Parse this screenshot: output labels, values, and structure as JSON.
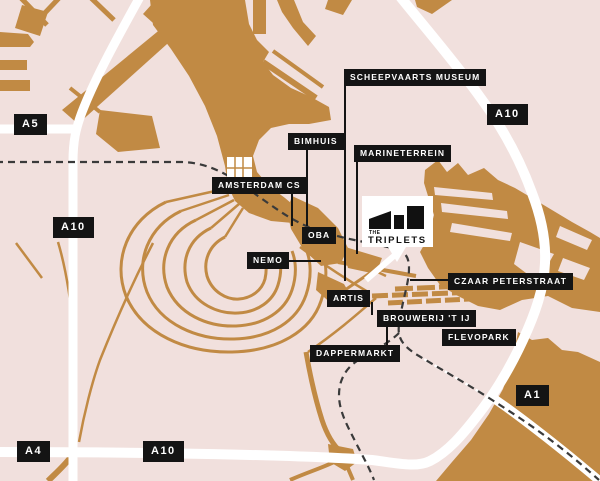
{
  "palette": {
    "background_pink": "#f1e0dd",
    "water_gold": "#c18a44",
    "road_white": "#ffffff",
    "label_background": "#141414",
    "label_text": "#ffffff",
    "railway_dash": "#3a3a3a",
    "logo_black": "#111111"
  },
  "labels": [
    {
      "id": "scheepvaarts-museum",
      "text": "SCHEEPVAARTS MUSEUM"
    },
    {
      "id": "a10-northeast",
      "text": "A10"
    },
    {
      "id": "a5",
      "text": "A5"
    },
    {
      "id": "bimhuis",
      "text": "BIMHUIS"
    },
    {
      "id": "marineterrein",
      "text": "MARINETERREIN"
    },
    {
      "id": "amsterdam-cs",
      "text": "AMSTERDAM CS"
    },
    {
      "id": "a10-west",
      "text": "A10"
    },
    {
      "id": "oba",
      "text": "OBA"
    },
    {
      "id": "nemo",
      "text": "NEMO"
    },
    {
      "id": "czaar-peterstraat",
      "text": "CZAAR PETERSTRAAT"
    },
    {
      "id": "artis",
      "text": "ARTIS"
    },
    {
      "id": "brouwerij-t-ij",
      "text": "BROUWERIJ 'T IJ"
    },
    {
      "id": "flevopark",
      "text": "FLEVOPARK"
    },
    {
      "id": "dappermarkt",
      "text": "DAPPERMARKT"
    },
    {
      "id": "a1",
      "text": "A1"
    },
    {
      "id": "a4",
      "text": "A4"
    },
    {
      "id": "a10-south",
      "text": "A10"
    }
  ],
  "callout": {
    "brand_top": "THE",
    "brand_name": "TRIPLETS"
  }
}
